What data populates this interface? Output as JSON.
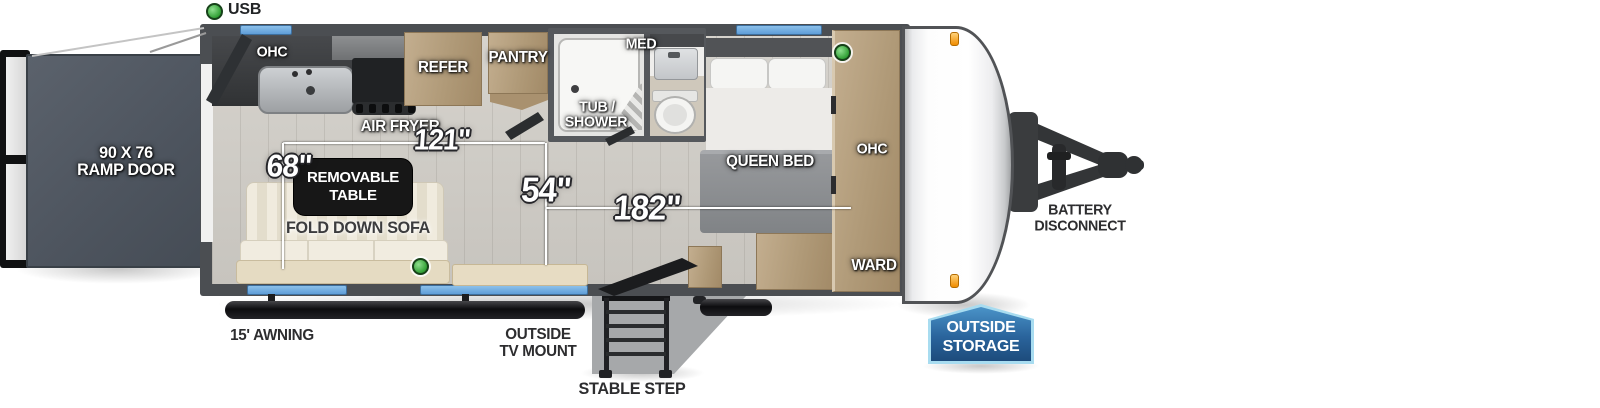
{
  "legend": {
    "usb": "USB"
  },
  "exterior": {
    "ramp_door": {
      "line1": "90 X 76",
      "line2": "RAMP DOOR"
    },
    "awning": "15' AWNING",
    "tv_mount": {
      "line1": "OUTSIDE",
      "line2": "TV MOUNT"
    },
    "stable_step": "STABLE STEP",
    "battery_disconnect": {
      "line1": "BATTERY",
      "line2": "DISCONNECT"
    },
    "outside_storage": {
      "line1": "OUTSIDE",
      "line2": "STORAGE"
    }
  },
  "kitchen": {
    "ohc": "OHC",
    "air_fryer": "AIR FRYER",
    "refer": "REFER",
    "pantry": "PANTRY"
  },
  "bath": {
    "tub_shower": {
      "line1": "TUB /",
      "line2": "SHOWER"
    },
    "med": "MED"
  },
  "bedroom": {
    "queen_bed": "QUEEN BED",
    "ohc": "OHC",
    "ward": "WARD"
  },
  "living": {
    "removable_table": {
      "line1": "REMOVABLE",
      "line2": "TABLE"
    },
    "fold_down_sofa": "FOLD DOWN SOFA"
  },
  "measurements": {
    "kitchen_run": "121\"",
    "dinette_width": "68\"",
    "interior_width": "54\"",
    "interior_length": "182\""
  },
  "colors": {
    "window_blue": "#5f9ed8",
    "usb_green": "#3aa93c",
    "storage_badge_blue": "#2a649c",
    "wood_tan": "#b39e81",
    "wall_gray": "#4b4e52",
    "ramp_slate": "#535a64",
    "marker_orange": "#f08c00"
  }
}
